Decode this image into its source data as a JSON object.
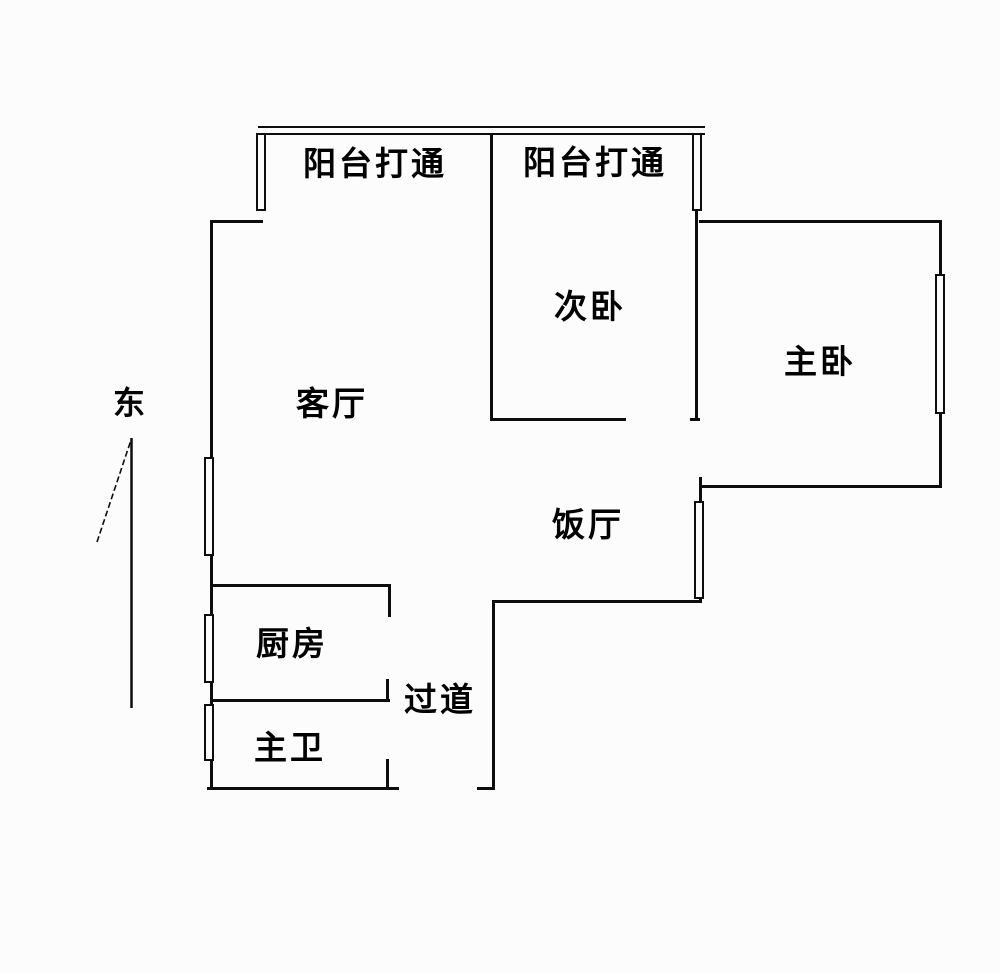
{
  "meta": {
    "title": "apartment-floor-plan",
    "background_color": "#fcfcfc",
    "line_color": "#0d0d0d",
    "text_color": "#000000"
  },
  "compass": {
    "label": "东"
  },
  "rooms": {
    "balcony_left": "阳台打通",
    "balcony_right": "阳台打通",
    "secondary_bedroom": "次卧",
    "master_bedroom": "主卧",
    "living_room": "客厅",
    "dining_room": "饭厅",
    "kitchen": "厨房",
    "corridor": "过道",
    "master_bathroom": "主卫"
  }
}
